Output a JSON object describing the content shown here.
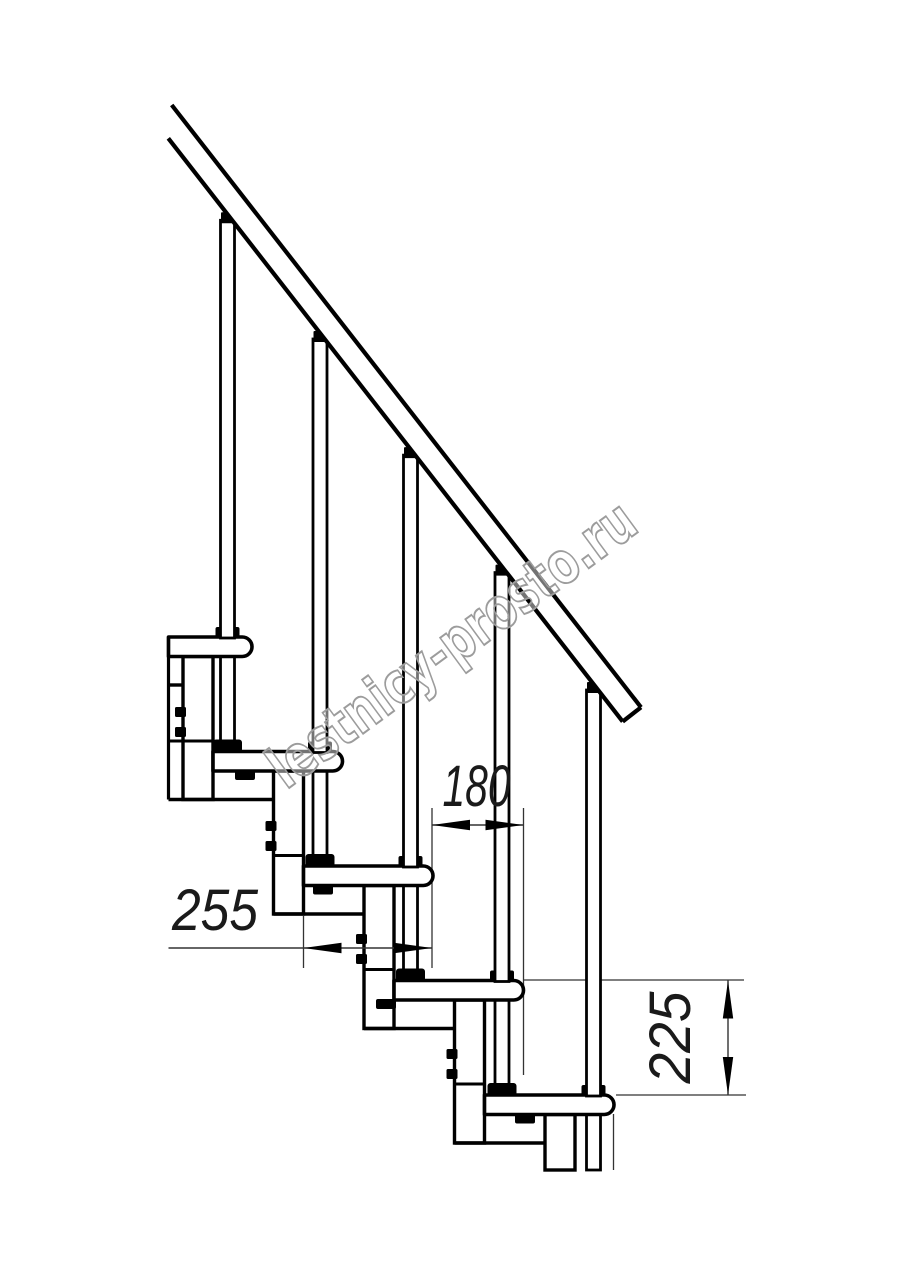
{
  "canvas": {
    "width": 914,
    "height": 1280,
    "background": "#ffffff",
    "stroke_color": "#000000",
    "thin_line_color": "#333333",
    "dim_text_color": "#1a1a1a"
  },
  "drawing_title": "Modular staircase side elevation",
  "watermark": {
    "text": "lestnicy-prosto.ru",
    "cx": 463.5,
    "cy": 660,
    "angle_deg": -36.25,
    "font_size": 58,
    "text_length": 440,
    "stroke_color": "#9c9c9c",
    "fill": "rgba(255,255,255,0.45)"
  },
  "rail": {
    "x_start_top": 171.7,
    "y_start_top": 105,
    "x_start_bottom": 168.3,
    "y_start_bottom": 138.3,
    "slope": 1.2834,
    "x_end_top": 641,
    "stroke_width": 4.2
  },
  "tread_thickness": 19.5,
  "treads": [
    {
      "top": 637,
      "nose": 252,
      "back": 168.5
    },
    {
      "top": 751.5,
      "nose": 342.5,
      "back": 213
    },
    {
      "top": 866,
      "nose": 433,
      "back": 303.5
    },
    {
      "top": 980.5,
      "nose": 523.5,
      "back": 394
    },
    {
      "top": 1095,
      "nose": 614,
      "back": 484.5
    }
  ],
  "balusters": [
    {
      "x": 227.5,
      "tread_index": 0,
      "nut_x": 245
    },
    {
      "x": 320,
      "tread_index": 1,
      "nut_x": 323
    },
    {
      "x": 410.5,
      "tread_index": 2,
      "nut_x": 386
    },
    {
      "x": 502,
      "tread_index": 3,
      "nut_x": 525
    },
    {
      "x": 593.5,
      "tread_index": 4,
      "tail_end_y": 1170
    }
  ],
  "columns": [
    {
      "left": 183,
      "right": 213,
      "top": 656.5,
      "bottom": 799.5,
      "joint_y": 741,
      "joint_left": 168.5,
      "bolt_ys": [
        707,
        727
      ]
    },
    {
      "left": 273.5,
      "right": 303.5,
      "top": 771,
      "bottom": 914,
      "joint_y": 855.5,
      "bolt_ys": [
        821,
        841
      ]
    },
    {
      "left": 364,
      "right": 394,
      "top": 885.5,
      "bottom": 1028.5,
      "joint_y": 969.5,
      "bolt_ys": [
        934,
        954
      ]
    },
    {
      "left": 454.5,
      "right": 484.5,
      "top": 1000,
      "bottom": 1143,
      "joint_y": 1084,
      "bolt_ys": [
        1049,
        1069
      ]
    },
    {
      "left": 545,
      "right": 575,
      "top": 1114.5,
      "bottom": 1170
    }
  ],
  "sleeve_lines": [
    {
      "y": 685,
      "x1": 168.5,
      "x2": 183
    },
    {
      "y": 799.5,
      "x1": 168.5,
      "x2": 273.5
    },
    {
      "y": 914,
      "x1": 273.5,
      "x2": 364
    },
    {
      "y": 1028.5,
      "x1": 364,
      "x2": 454.5
    },
    {
      "y": 1143,
      "x1": 454.5,
      "x2": 545
    }
  ],
  "cut_line": {
    "x": 168.5,
    "y1": 637,
    "y2": 799.5
  },
  "aux_thin_lines": [
    {
      "x1": 432,
      "y1": 808,
      "x2": 432,
      "y2": 968
    },
    {
      "x1": 523.5,
      "y1": 808,
      "x2": 523.5,
      "y2": 1075
    },
    {
      "x1": 303.5,
      "y1": 916,
      "x2": 303.5,
      "y2": 968
    },
    {
      "x1": 613.5,
      "y1": 1114,
      "x2": 613.5,
      "y2": 1170
    },
    {
      "x1": 523.5,
      "y1": 980,
      "x2": 744,
      "y2": 980
    },
    {
      "x1": 616,
      "y1": 1095,
      "x2": 746,
      "y2": 1095
    }
  ],
  "dimensions": [
    {
      "label": "180",
      "type": "h",
      "y": 825,
      "x1": 432,
      "x2": 523.5,
      "line_x1": 432,
      "line_x2": 523.5,
      "text_x": 476.5,
      "text_y": 806,
      "text_length": 68
    },
    {
      "label": "255",
      "type": "h",
      "y": 948,
      "x1": 303.5,
      "x2": 432,
      "line_x1": 168.5,
      "line_x2": 432,
      "text_x": 215,
      "text_y": 930,
      "text_length": 86
    },
    {
      "label": "225",
      "type": "v",
      "x": 728,
      "y1": 980.5,
      "y2": 1095,
      "text_x": 690,
      "text_y": 1037.5,
      "text_length": 92
    }
  ],
  "dim_font_size": 58,
  "arrow": {
    "length": 38,
    "half_width": 5.2
  }
}
